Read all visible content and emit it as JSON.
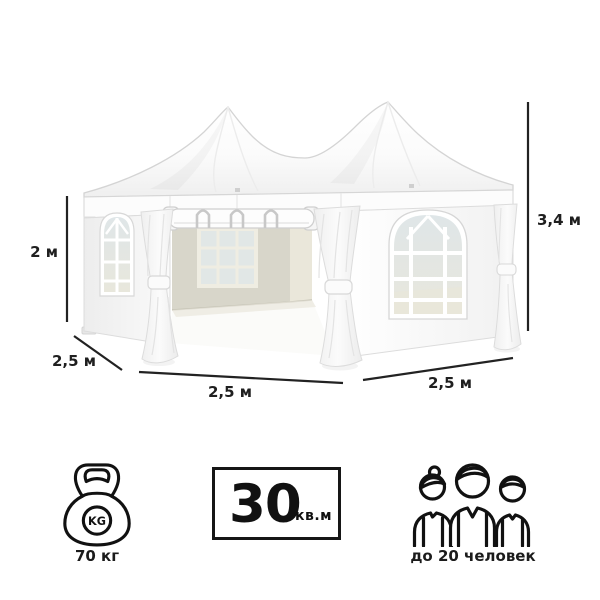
{
  "illustration": {
    "subject": "white-hexagonal-pavilion-tent",
    "colors": {
      "tent_white": "#ffffff",
      "tent_shade": "#f0f0f0",
      "outline": "#d6d6d6",
      "interior_wall": "#d8d6ca",
      "interior_wall_light": "#eae7da",
      "window_glass": "#e1e7e7",
      "dimension_line": "#222222",
      "text": "#1f1f1f",
      "icon_stroke": "#111111"
    }
  },
  "dimensions": {
    "wall_height": "2 м",
    "total_height": "3,4 м",
    "side_depth": "2,5 м",
    "front_width": "2,5 м",
    "right_width": "2,5 м"
  },
  "specs": {
    "weight": {
      "icon": "kettlebell-icon",
      "kettlebell_text": "KG",
      "label": "70 кг"
    },
    "area": {
      "icon": "area-box",
      "value": "30",
      "unit": "кв.м"
    },
    "capacity": {
      "icon": "people-icon",
      "label": "до 20 человек"
    }
  }
}
